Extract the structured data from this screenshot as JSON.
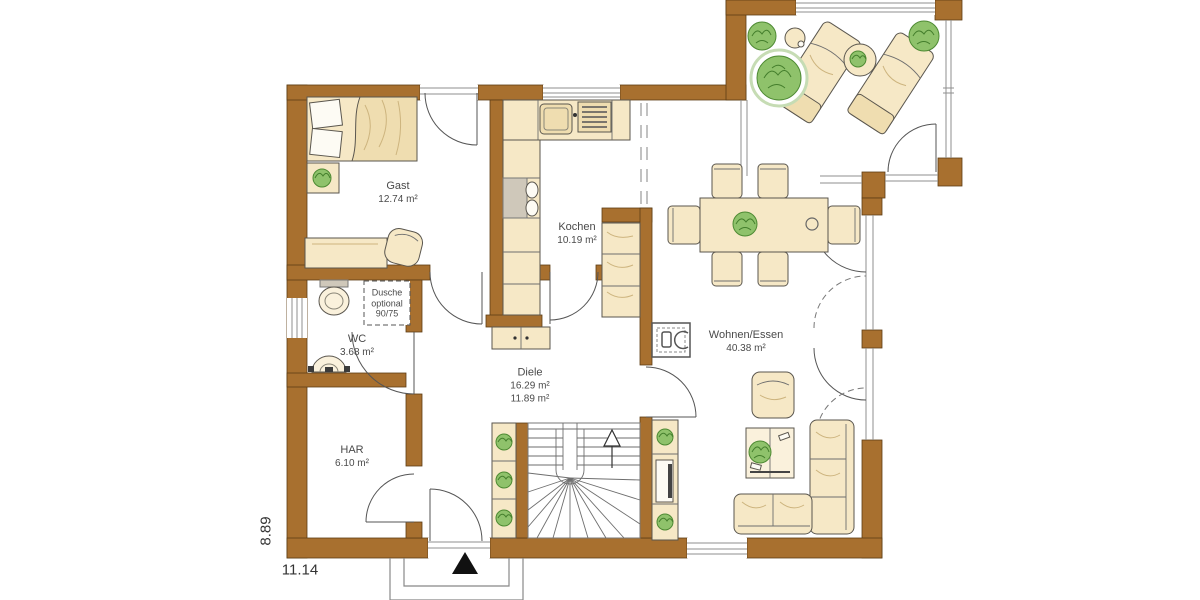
{
  "rooms": {
    "gast": {
      "name": "Gast",
      "area": "12.74 m²"
    },
    "kochen": {
      "name": "Kochen",
      "area": "10.19 m²"
    },
    "wc": {
      "name": "WC",
      "area": "3.68 m²"
    },
    "har": {
      "name": "HAR",
      "area": "6.10 m²"
    },
    "diele": {
      "name": "Diele",
      "area_upper": "16.29 m²",
      "area_lower": "11.89 m²"
    },
    "wohnen": {
      "name": "Wohnen/Essen",
      "area": "40.38 m²"
    }
  },
  "shower_note": {
    "line1": "Dusche",
    "line2": "optional",
    "line3": "90/75"
  },
  "dimensions": {
    "height_left": "8.89",
    "width_bottom": "11.14"
  },
  "colors": {
    "wall": "#A8702F",
    "furniture": "#F6E8C6",
    "plant": "#8FC26B",
    "appliance": "#CFC8BA",
    "text": "#4A4A4A"
  }
}
